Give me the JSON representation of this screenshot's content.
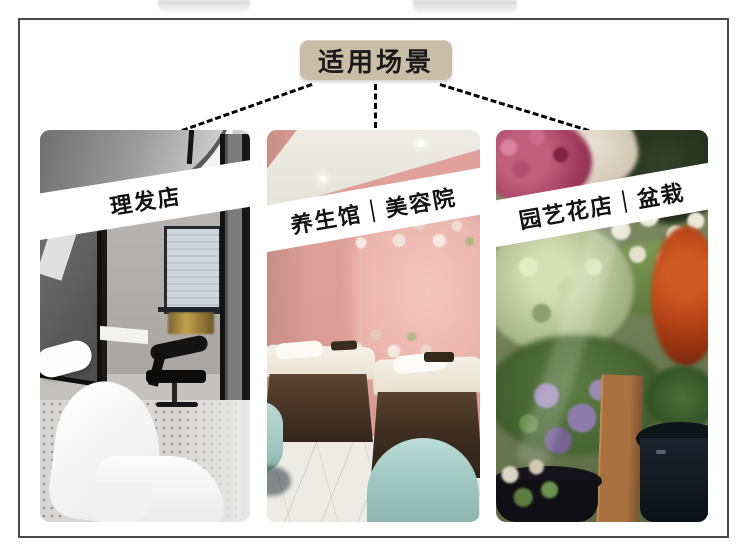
{
  "header": {
    "badge_label": "适用场景"
  },
  "scenes": [
    {
      "label": "理发店"
    },
    {
      "label": "养生馆｜美容院"
    },
    {
      "label": "园艺花店｜盆栽"
    }
  ],
  "colors": {
    "page_bg": "#ffffff",
    "frame_border": "#4a4a4a",
    "badge_bg": "#c9bda7",
    "badge_text": "#1a1a1a",
    "banner_bg": "#ffffff",
    "banner_text": "#121212",
    "connector": "#1c1c1c",
    "spa_pink": "#db9c95",
    "stool_teal": "#a3c9c4",
    "bed_brown": "#4a3728"
  }
}
